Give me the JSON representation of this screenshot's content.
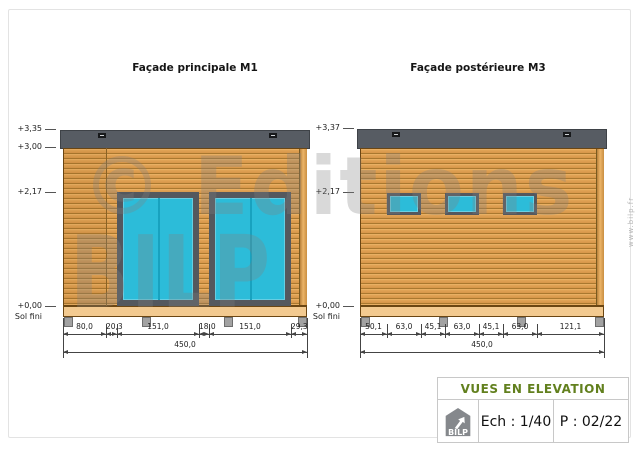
{
  "watermark": {
    "line1": "© Editions",
    "line2": "BILP",
    "side_url": "www.bilp.fr"
  },
  "left_facade": {
    "title": "Façade principale M1",
    "levels": {
      "roof_top": "+3,35",
      "roof_bottom": "+3,00",
      "lintel": "+2,17",
      "ground": "+0,00",
      "ground_sub": "Sol fini"
    },
    "dims": [
      "80,0",
      "20,3",
      "151,0",
      "18,0",
      "151,0",
      "29,3"
    ],
    "total": "450,0"
  },
  "right_facade": {
    "title": "Façade postérieure M3",
    "levels": {
      "roof_top": "+3,37",
      "lintel": "+2,17",
      "ground": "+0,00",
      "ground_sub": "Sol fini"
    },
    "dims": [
      "50,1",
      "63,0",
      "45,1",
      "63,0",
      "45,1",
      "63,0",
      "121,1"
    ],
    "total": "450,0"
  },
  "title_block": {
    "heading": "VUES EN ELEVATION",
    "scale": "Ech : 1/40",
    "page": "P : 02/22",
    "logo": "BILP"
  },
  "colors": {
    "accent_green": "#62801e",
    "roof_gray": "#575c63",
    "glass_cyan": "#2cbcd9",
    "wood": "#dfa052"
  }
}
